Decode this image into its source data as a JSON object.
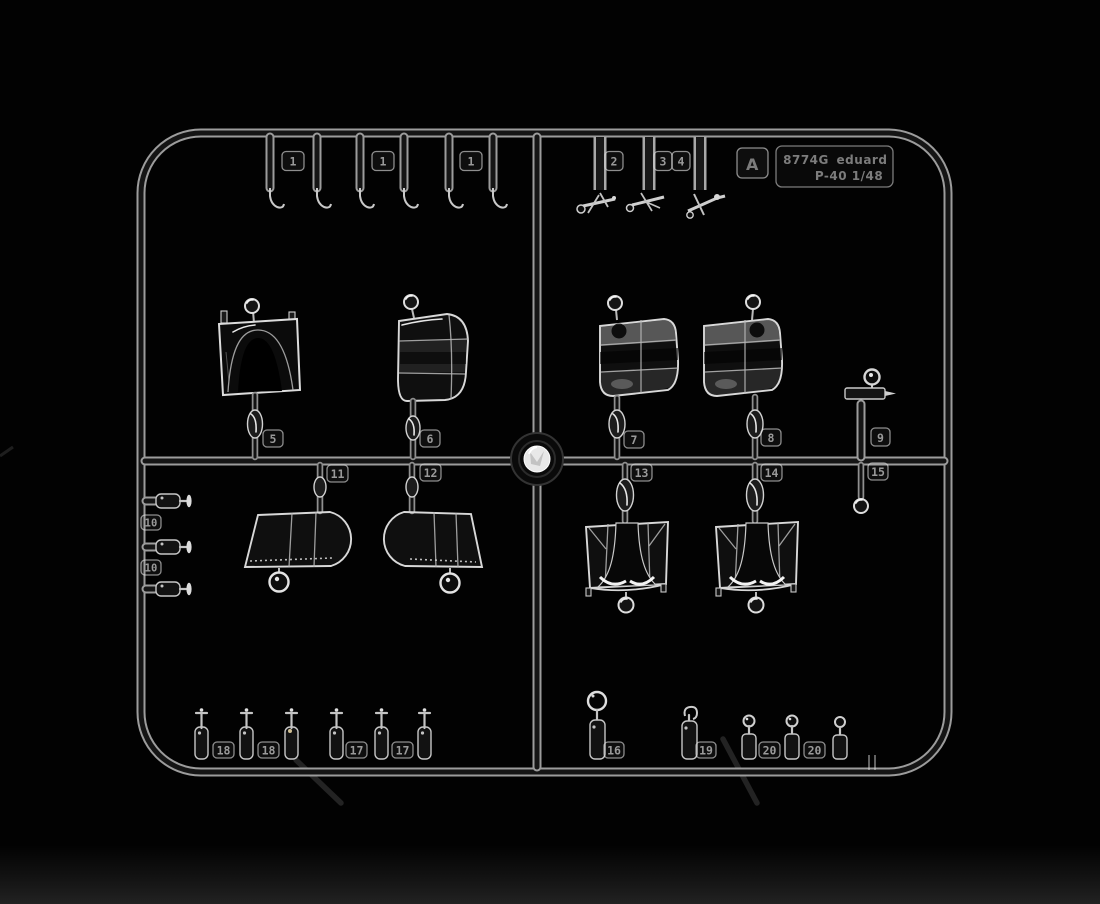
{
  "sprue": {
    "marking": {
      "code": "8774G",
      "brand": "eduard",
      "scale_line": "P-40 1/48"
    },
    "sprue_letter": "A",
    "tags": [
      {
        "label": "1"
      },
      {
        "label": "1"
      },
      {
        "label": "1"
      },
      {
        "label": "2"
      },
      {
        "label": "3"
      },
      {
        "label": "4"
      },
      {
        "label": "5"
      },
      {
        "label": "6"
      },
      {
        "label": "7"
      },
      {
        "label": "8"
      },
      {
        "label": "9"
      },
      {
        "label": "10"
      },
      {
        "label": "10"
      },
      {
        "label": "11"
      },
      {
        "label": "12"
      },
      {
        "label": "13"
      },
      {
        "label": "14"
      },
      {
        "label": "15"
      },
      {
        "label": "16"
      },
      {
        "label": "17"
      },
      {
        "label": "17"
      },
      {
        "label": "18"
      },
      {
        "label": "18"
      },
      {
        "label": "19"
      },
      {
        "label": "20"
      },
      {
        "label": "20"
      }
    ],
    "colors": {
      "background": "#020202",
      "plastic_edge": "#d8d8d8",
      "runner_core": "#151515",
      "runner_edge": "#9c9c9c"
    }
  }
}
